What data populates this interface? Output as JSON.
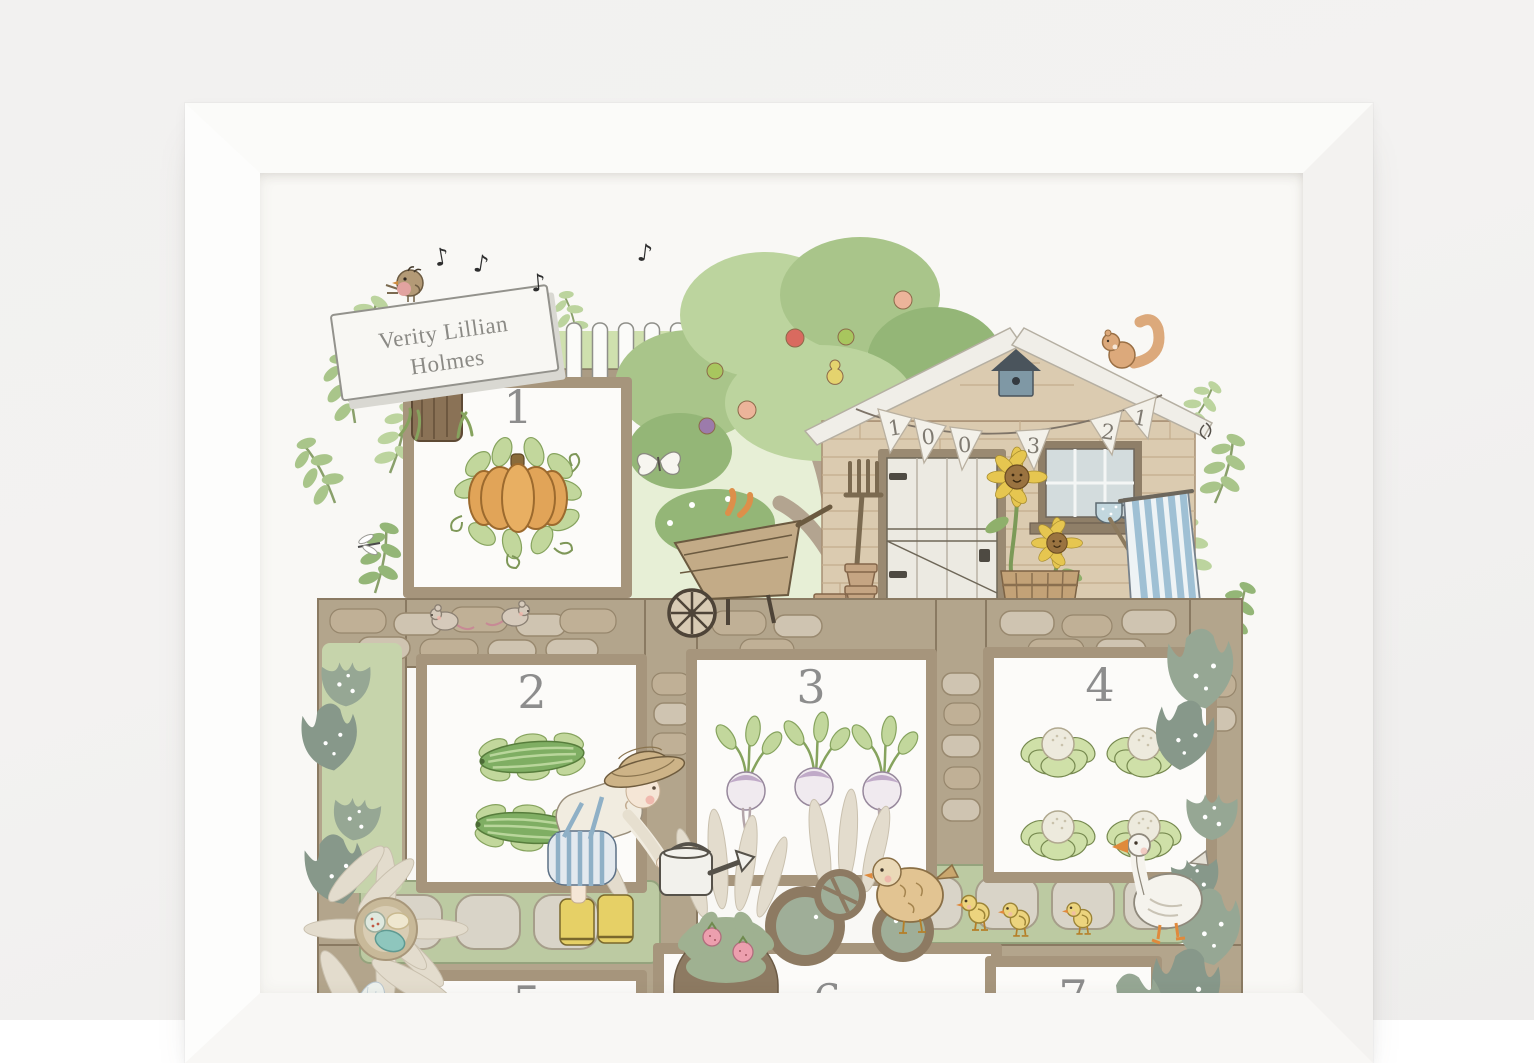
{
  "scene": {
    "description": "white framed personalised garden counting print on a white wall",
    "wall_color": "#f1f0ef",
    "frame_color": "#fbfbf9",
    "paper_color": "#f9f8f5"
  },
  "print": {
    "name_sign": {
      "line1": "Verity Lillian",
      "line2": "Holmes"
    },
    "bunting_digits": [
      "1",
      "0",
      "0",
      "3",
      "2",
      "1"
    ],
    "music_note": "♪",
    "squares": [
      {
        "number": "1",
        "item": "pumpkin",
        "count": 1
      },
      {
        "number": "2",
        "item": "cucumbers",
        "count": 2
      },
      {
        "number": "3",
        "item": "turnips",
        "count": 3
      },
      {
        "number": "4",
        "item": "cauliflowers",
        "count": 4
      },
      {
        "number": "5"
      },
      {
        "number": "6"
      },
      {
        "number": "7"
      }
    ],
    "colors": {
      "leaf_green": "#a9c58a",
      "sage_paper": "#96a794",
      "path_tan": "#b3a58c",
      "shed_brick": "#dbcbb0",
      "pumpkin_orange": "#e1a458",
      "boot_yellow": "#e6d066",
      "deckchair_blue": "#9fc0d4",
      "number_grey": "#8d8d8d"
    }
  }
}
